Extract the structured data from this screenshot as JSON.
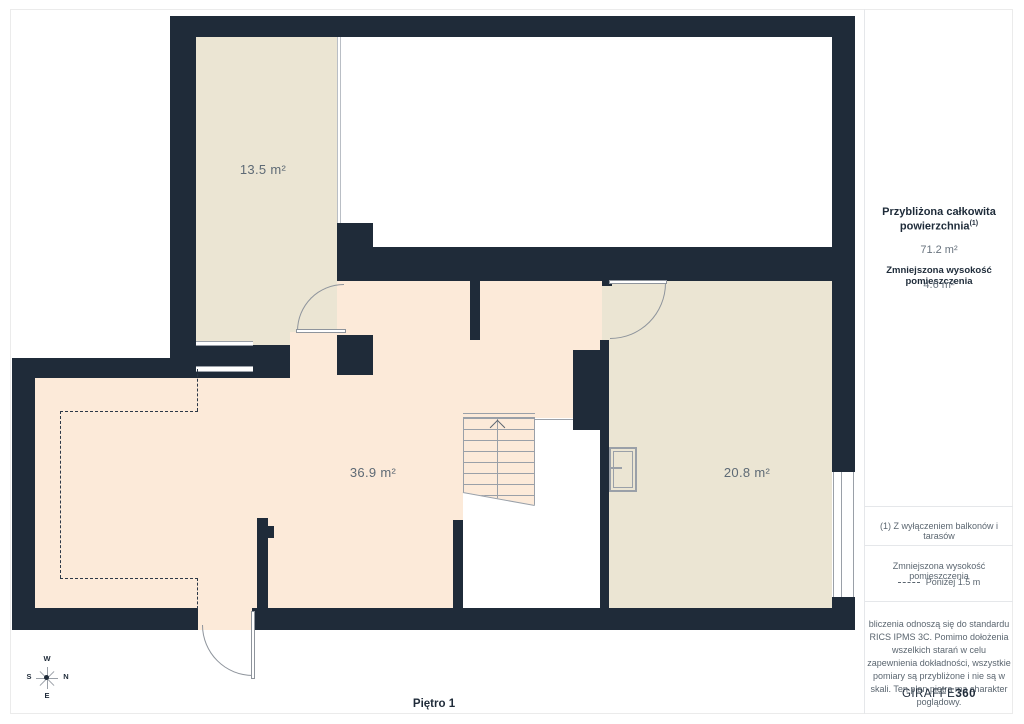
{
  "plan": {
    "floor_label": "Piętro 1",
    "rooms": [
      {
        "id": "room-top-left",
        "area_label": "13.5 m²"
      },
      {
        "id": "room-main",
        "area_label": "36.9 m²"
      },
      {
        "id": "room-right",
        "area_label": "20.8 m²"
      }
    ],
    "compass": {
      "w": "W",
      "n": "N",
      "s": "S",
      "e": "E"
    }
  },
  "sidebar": {
    "total_area_title_line1": "Przybliżona całkowita",
    "total_area_title_line2": "powierzchnia",
    "total_area_superscript": "(1)",
    "total_area_value": "71.2 m²",
    "reduced_height_title": "Zmniejszona wysokość pomieszczenia",
    "reduced_height_value": "4.6 m²",
    "footnote": "(1) Z wyłączeniem balkonów i tarasów",
    "legend_title": "Zmniejszona wysokość pomieszczenia",
    "legend_dashed_label": "Poniżej 1.5 m",
    "disclaimer": "bliczenia odnoszą się do standardu RICS IPMS 3C. Pomimo dołożenia wszelkich starań w celu zapewnienia dokładności, wszystkie pomiary są przybliżone i nie są w skali. Ten plan piętra ma charakter poglądowy.",
    "logo_text": "GIRAFFE",
    "logo_suffix": "360"
  },
  "colors": {
    "wall": "#1f2b39",
    "room_beige": "#ebe5d3",
    "room_peach": "#fcead9",
    "void_white": "#ffffff",
    "line_gray": "#9aa0a8",
    "text_dark": "#1e2b39",
    "text_gray": "#5b6670"
  }
}
